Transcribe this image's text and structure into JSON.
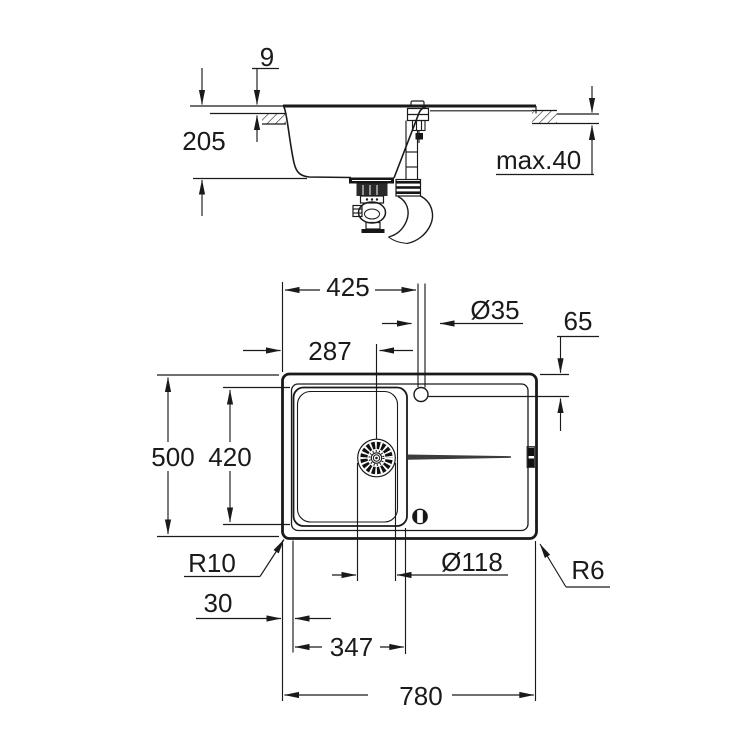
{
  "ink_color": "#1a1a1a",
  "side_view": {
    "rim_height": "9",
    "bowl_depth": "205",
    "max_counter_thickness": "max.40"
  },
  "top_view": {
    "faucet_offset_x": "425",
    "faucet_hole_diameter": "Ø35",
    "faucet_offset_y": "65",
    "drain_offset_x": "287",
    "overall_depth": "500",
    "bowl_inner_depth": "420",
    "corner_radius_inner": "R10",
    "drain_diameter": "Ø118",
    "corner_radius_outer": "R6",
    "rim_to_bowl": "30",
    "bowl_inner_width": "347",
    "overall_width": "780"
  }
}
